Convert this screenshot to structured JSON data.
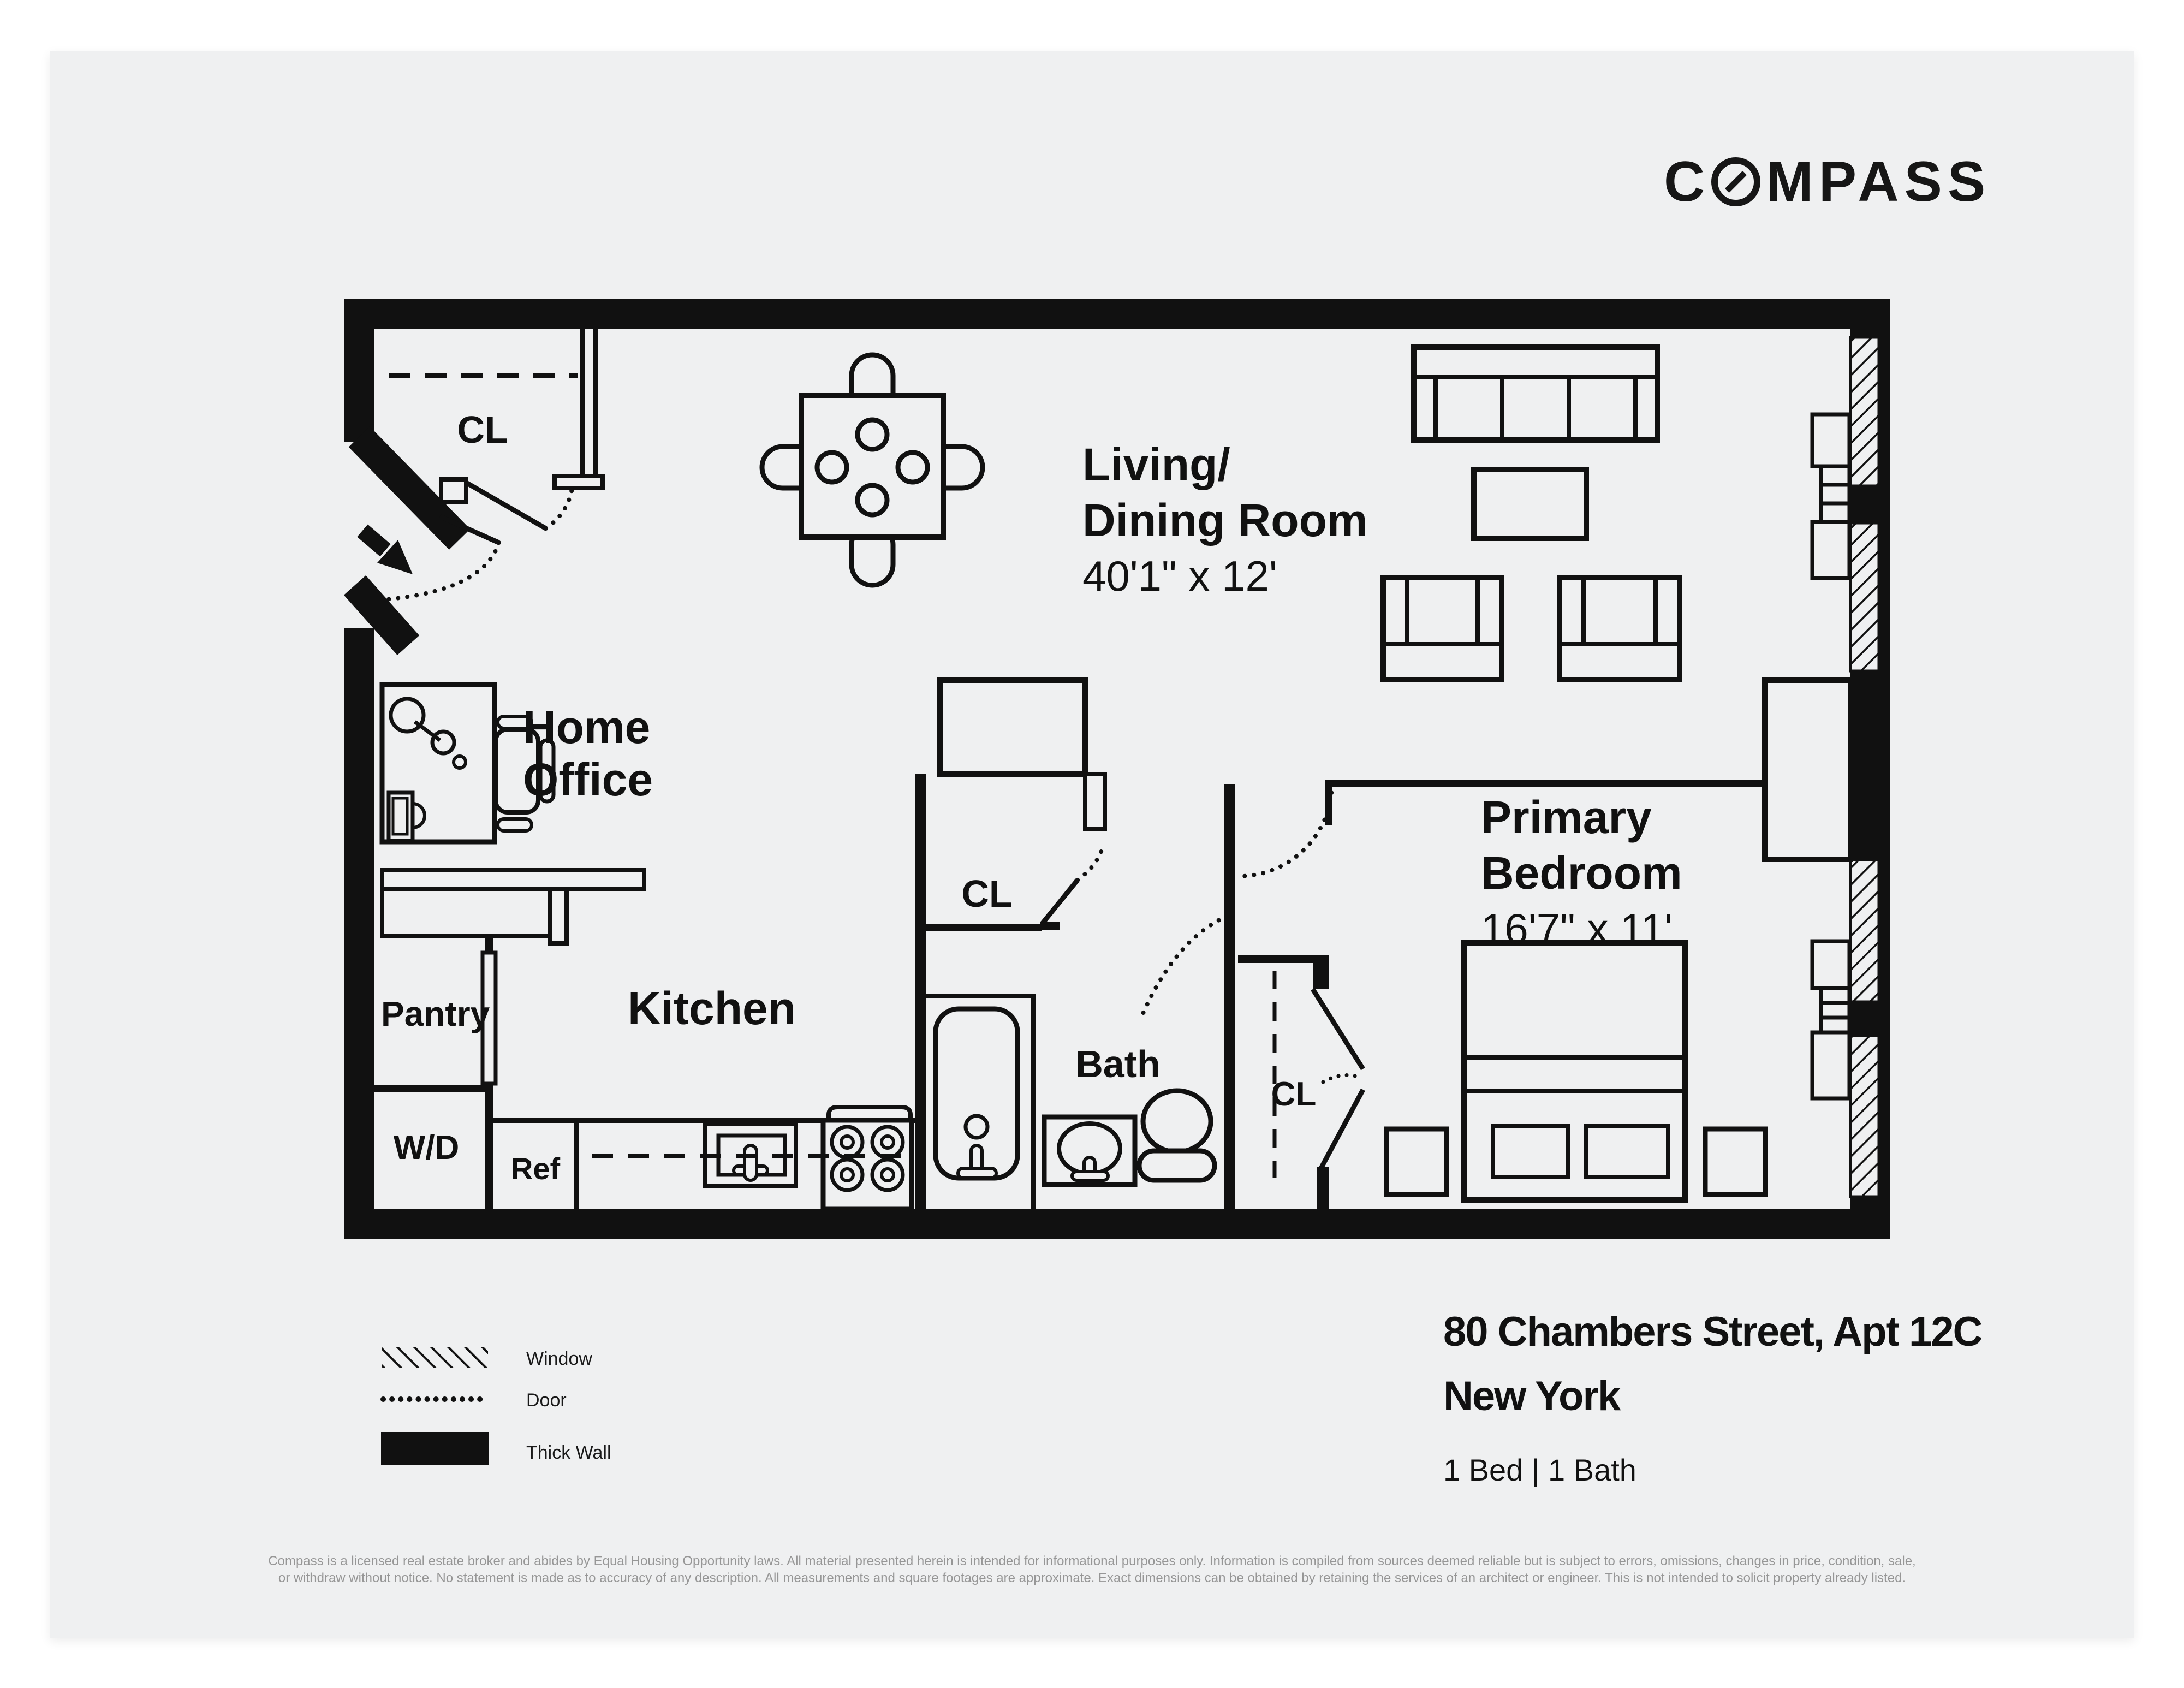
{
  "brand": {
    "logo_prefix": "C",
    "logo_suffix": "MPASS",
    "logo_full": "COMPASS"
  },
  "rooms": {
    "living_dining": {
      "name_line1": "Living/",
      "name_line2": "Dining Room",
      "dimensions": "40'1\" x 12'"
    },
    "primary_bedroom": {
      "name_line1": "Primary",
      "name_line2": "Bedroom",
      "dimensions": "16'7\" x 11'"
    },
    "home_office": {
      "name_line1": "Home",
      "name_line2": "Office"
    },
    "kitchen": {
      "name": "Kitchen"
    },
    "pantry": {
      "name": "Pantry"
    },
    "bath": {
      "name": "Bath"
    }
  },
  "fixtures": {
    "washer_dryer": "W/D",
    "refrigerator": "Ref",
    "closet_entry": "CL",
    "closet_hall": "CL",
    "closet_bedroom": "CL"
  },
  "legend": {
    "window_label": "Window",
    "door_label": "Door",
    "thick_wall_label": "Thick Wall"
  },
  "listing": {
    "address_line1": "80 Chambers Street, Apt 12C",
    "address_line2": "New York",
    "bed_bath": "1 Bed | 1 Bath"
  },
  "disclaimer": {
    "line1": "Compass is a licensed real estate broker and abides by Equal Housing Opportunity laws. All material presented herein is intended for informational purposes only. Information is compiled from sources deemed reliable but is subject to errors, omissions, changes in price, condition, sale,",
    "line2": "or withdraw without notice. No statement is made as to accuracy of any description. All measurements and square footages are approximate. Exact dimensions can be obtained by retaining the services of an architect or engineer. This is not intended to solicit property already listed."
  },
  "colors": {
    "page_background": "#ffffff",
    "sheet_background": "#eff0f1",
    "ink": "#111111",
    "disclaimer_text": "#969696"
  }
}
